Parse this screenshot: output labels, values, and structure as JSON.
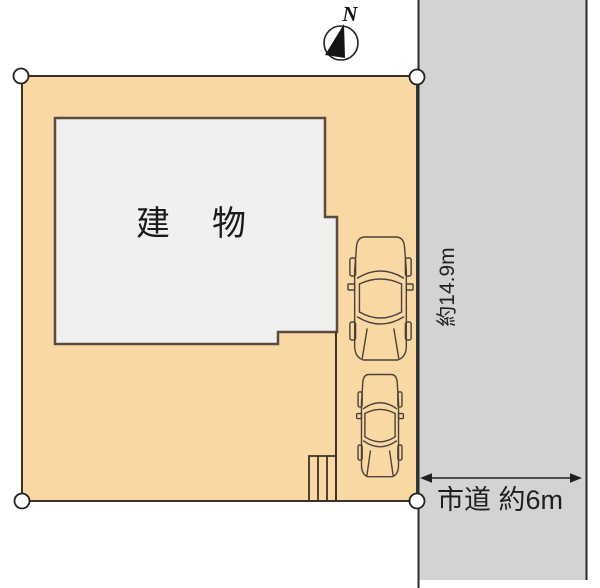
{
  "compass": {
    "north_label": "N"
  },
  "plan": {
    "building_label": "建　物",
    "frontage_label": "約14.9m",
    "road_label": "市道 約6m"
  },
  "icons": {
    "compass": "north-compass-icon",
    "car": "car-top-view-icon",
    "stairs": "entrance-steps-icon",
    "corner_marker": "boundary-point-marker"
  },
  "colors": {
    "lot_fill": "#F9D8A4",
    "building_fill": "#F0F0EE",
    "road_fill": "#D3D3D3",
    "outline": "#3B332B",
    "car_stroke": "#4A423A"
  }
}
